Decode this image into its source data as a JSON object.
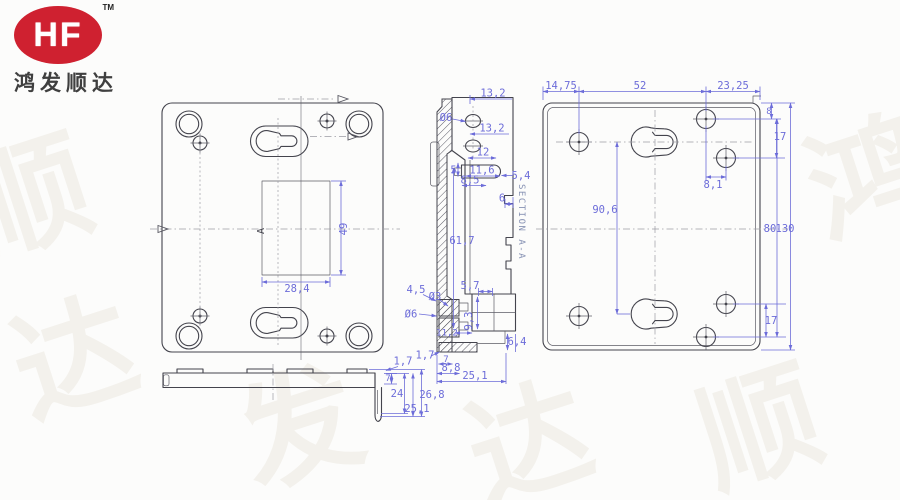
{
  "logo": {
    "brand": "HF",
    "tm": "TM",
    "company": "鸿发顺达",
    "red": "#cf2130"
  },
  "drawing": {
    "colors": {
      "outline": "#44444d",
      "dimension": "#6c6cd9",
      "centerline": "#9b9ba4",
      "section_text": "#8691b3"
    },
    "front_view": {
      "section_marker": "A",
      "dims": {
        "rect_height": "49",
        "rect_width": "28,4"
      }
    },
    "section_view": {
      "title": "SECTION A-A",
      "dims": {
        "d13_2_top": "13,2",
        "dia6_top": "Ø6",
        "d13_2_mid": "13,2",
        "d12": "12",
        "d5": "5",
        "d11_6": "11,6",
        "d5_4": "5,4",
        "d8_5": "8,5",
        "d6": "6",
        "d61_7": "61,7",
        "d5_7": "5,7",
        "d4_5": "4,5",
        "dia3": "Ø3",
        "dia6_bottom": "Ø6",
        "d9_3": "9,3",
        "d11_2": "11,2",
        "d6_4": "6,4",
        "d1_7": "1,7",
        "d7": "7",
        "d8_8": "8,8",
        "d25_1": "25,1"
      }
    },
    "side_view": {
      "dims": {
        "d1_7": "1,7",
        "d7": "7",
        "d24": "24",
        "d26_8": "26,8",
        "d25_1": "25,1"
      }
    },
    "rear_view": {
      "dims": {
        "d14_75": "14,75",
        "d52": "52",
        "d23_25": "23,25",
        "d8": "8",
        "d17_top": "17",
        "d8_1": "8,1",
        "d90_6": "90,6",
        "d80": "80",
        "d130": "130",
        "d17_bottom": "17"
      }
    }
  },
  "watermark": {
    "chars": [
      "鸿",
      "发",
      "顺",
      "达"
    ]
  }
}
